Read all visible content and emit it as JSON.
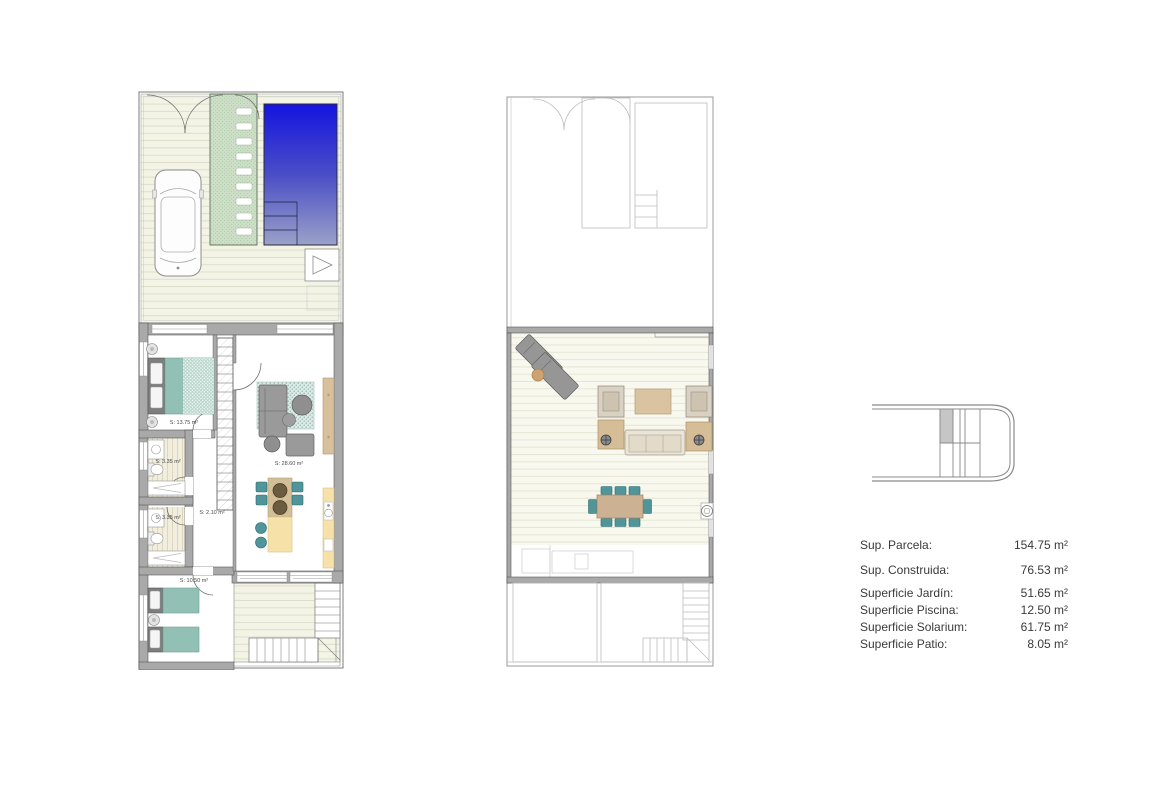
{
  "document": {
    "kind": "floor-plan-sheet",
    "background": "#ffffff"
  },
  "ground_floor": {
    "room_labels": [
      {
        "id": "bedroom-1",
        "text": "S: 13.75 m²"
      },
      {
        "id": "bathroom-1",
        "text": "S: 3.35 m²"
      },
      {
        "id": "bathroom-2",
        "text": "S: 3.35 m²"
      },
      {
        "id": "hallway",
        "text": "S: 2.10 m²"
      },
      {
        "id": "living-kitchen",
        "text": "S: 28.60 m²"
      },
      {
        "id": "bedroom-2",
        "text": "S: 10.50 m²"
      }
    ]
  },
  "summary": {
    "rows": [
      {
        "label": "Sup. Parcela:",
        "value": "154.75 m²"
      },
      {
        "label": "Sup. Construida:",
        "value": "76.53 m²"
      },
      {
        "label": "Superficie Jardín:",
        "value": "51.65 m²"
      },
      {
        "label": "Superficie Piscina:",
        "value": "12.50 m²"
      },
      {
        "label": "Superficie Solarium:",
        "value": "61.75 m²"
      },
      {
        "label": "Superficie Patio:",
        "value": "8.05 m²"
      }
    ]
  },
  "colors": {
    "pool-top": "#1414e0",
    "pool-mid": "#4a4ec6",
    "pool-bottom": "#9ba1c8",
    "garden": "#cfe0c8",
    "garden-dot": "#9cbd9a",
    "deck-bg": "#f3f4e6",
    "deck-line": "#dcdfca",
    "deck2-bg": "#f8f8ee",
    "deck2-line": "#e4e6d5",
    "teal": "#93c0b5",
    "teal-dark": "#4f959a",
    "tan": "#d7c09b",
    "cream": "#f6e2a9",
    "sand": "#d2bf97",
    "wall": "#a9a9a9",
    "line-dark": "#4e4e4e",
    "text": "#3a3a3a"
  }
}
